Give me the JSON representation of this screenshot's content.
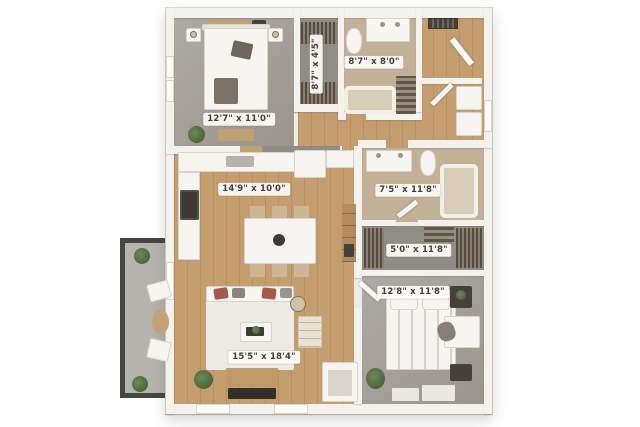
{
  "image": {
    "type": "3d-rendered apartment floor plan",
    "background": "#ffffff"
  },
  "palette": {
    "wall": "#f4f2ed",
    "wood_floor": "#c59e70",
    "carpet": "#a3a09a",
    "carpet_dark": "#908d86",
    "bath_tile": "#c3b197",
    "balcony_frame": "#46453f",
    "label_bg": "#fbfaf7",
    "label_text": "#403e39",
    "plant_green": "#4c6b3c",
    "pillow_red": "#a8594c"
  },
  "rooms": [
    {
      "id": "bedroom-1",
      "dims": "12'7\" x 11'0\"",
      "floor": "carpet"
    },
    {
      "id": "closet-1",
      "dims": "8'7\" x 4'5\"",
      "floor": "carpet"
    },
    {
      "id": "bathroom-1",
      "dims": "8'7\" x 8'0\"",
      "floor": "tile"
    },
    {
      "id": "kitchen-dining",
      "dims": "14'9\" x 10'0\"",
      "floor": "wood"
    },
    {
      "id": "bathroom-2",
      "dims": "7'5\" x 11'8\"",
      "floor": "tile"
    },
    {
      "id": "walk-in-closet",
      "dims": "5'0\" x 11'8\"",
      "floor": "carpet"
    },
    {
      "id": "bedroom-2",
      "dims": "12'8\" x 11'8\"",
      "floor": "carpet"
    },
    {
      "id": "living-room",
      "dims": "15'5\" x 18'4\"",
      "floor": "wood"
    }
  ]
}
